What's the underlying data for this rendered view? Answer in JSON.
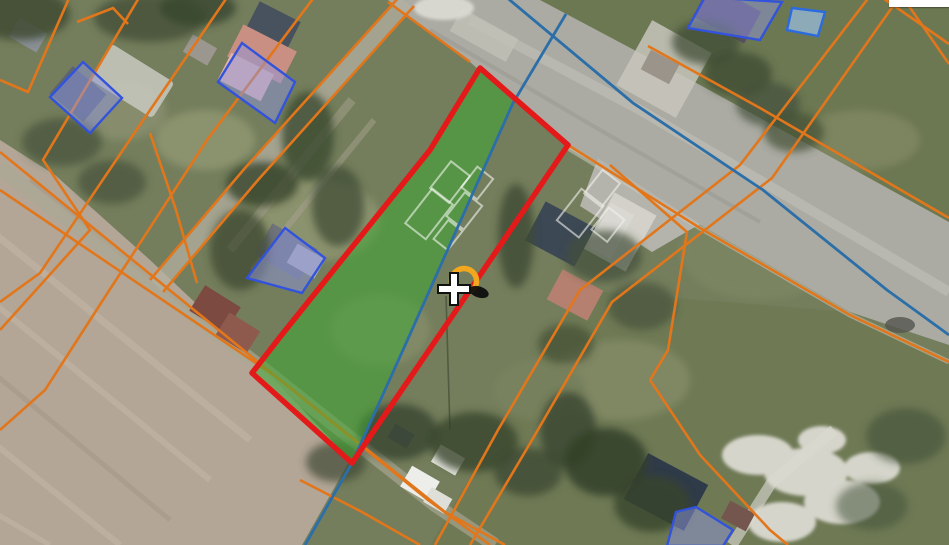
{
  "map": {
    "description": "aerial orthophoto with cadastral overlay, selected parcel highlighted",
    "cursor": {
      "style": "left:434px;top:265px"
    },
    "loading_marker": {
      "color": "#F2A71E"
    },
    "corner_panel": {
      "color": "#FFFFFF"
    },
    "layers": {
      "selected_parcel": {
        "stroke": "#E41A1A",
        "fill": "rgba(64,168,52,0.55)"
      },
      "parcel_boundaries": {
        "stroke": "#E2761B"
      },
      "reference_lines": {
        "stroke": "#2C6FA8"
      },
      "building_footprints": {
        "stroke": "#3353DC",
        "fill": "rgba(141,150,222,0.5)"
      },
      "building_footprint_light": {
        "stroke": "#2B6BE0",
        "fill": "rgba(158,196,240,0.65)"
      }
    }
  }
}
